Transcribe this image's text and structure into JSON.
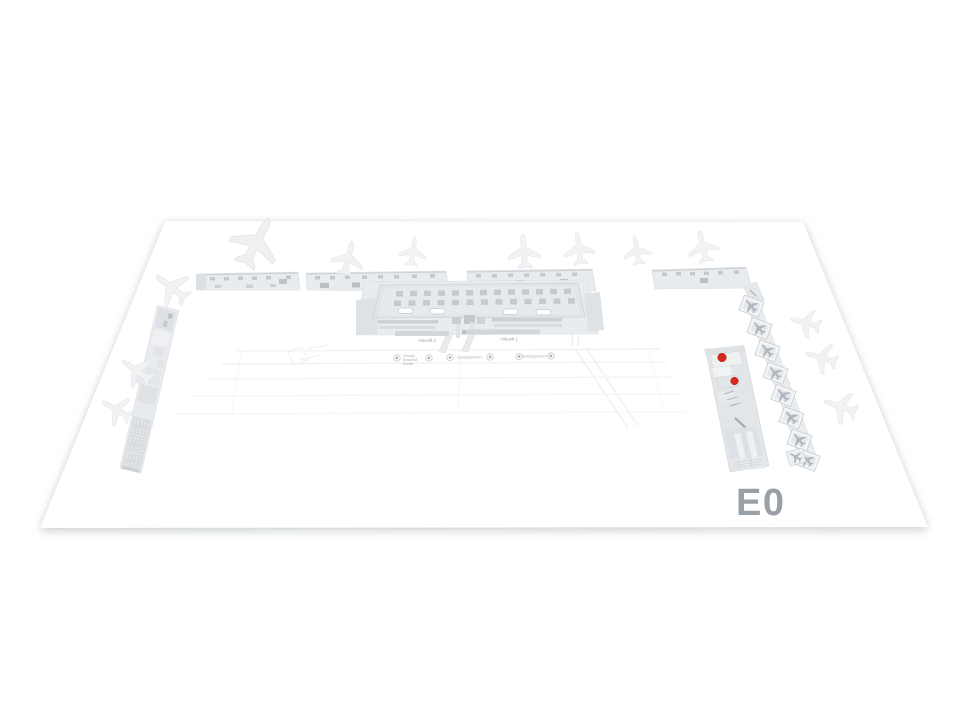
{
  "map": {
    "floor_label": "E0",
    "labels": {
      "arrival_2": "Ankunft 2",
      "arrival_1": "Ankunft 1"
    },
    "transit_stops": [
      {
        "lines": [
          "Umland-",
          "Busse/BA",
          "Shuttle"
        ]
      },
      {
        "lines": [
          "Bussteig B1/B71"
        ]
      },
      {
        "lines": [
          "Bussteig A1/A71"
        ]
      }
    ],
    "markers": [
      {
        "id": "marker-1"
      },
      {
        "id": "marker-2"
      }
    ],
    "colors": {
      "marker": "#d6281e",
      "floor_label": "#9aa0a7",
      "building": "#e9ecee",
      "building_detail": "#c5cad0",
      "aircraft_ghost": "#f1f2f4"
    }
  }
}
